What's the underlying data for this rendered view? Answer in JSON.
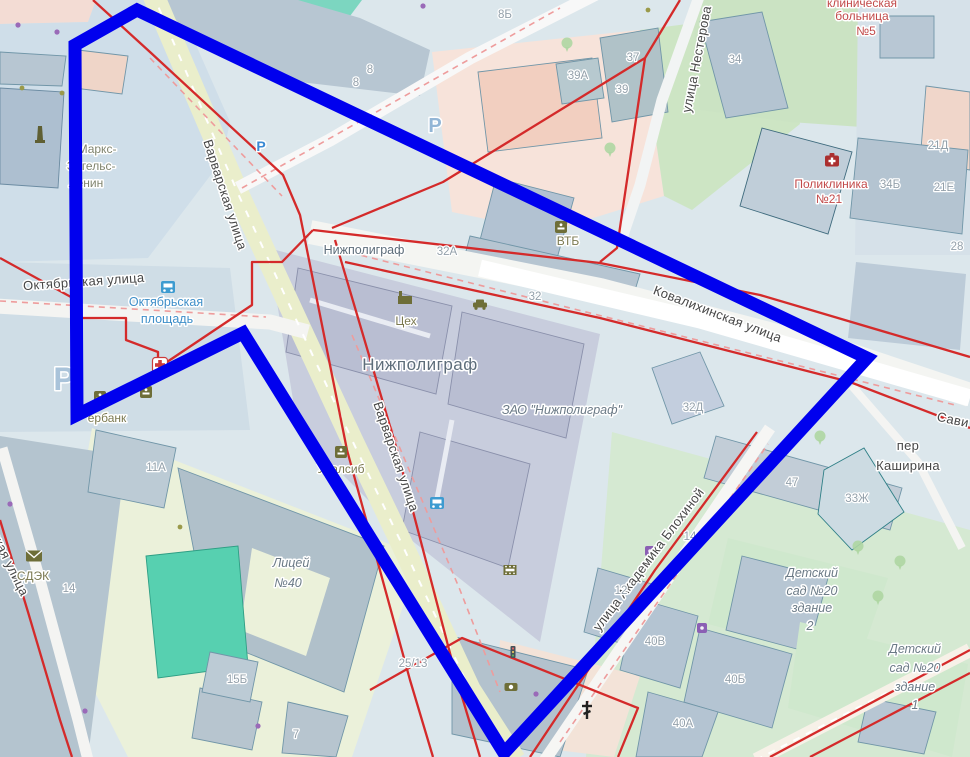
{
  "map": {
    "overlay_color": "#0000ee",
    "boundary_color": "#d42a2a",
    "boundary_dash_color": "#ee9c9c",
    "selection_polygon": [
      [
        75,
        45
      ],
      [
        137,
        10
      ],
      [
        867,
        358
      ],
      [
        504,
        753
      ],
      [
        243,
        333
      ],
      [
        77,
        415
      ]
    ],
    "red_boundaries": [
      [
        [
          93,
          0
        ],
        [
          150,
          52
        ],
        [
          283,
          175
        ],
        [
          300,
          215
        ],
        [
          347,
          450
        ],
        [
          410,
          680
        ],
        [
          433,
          757
        ]
      ],
      [
        [
          335,
          240
        ],
        [
          397,
          450
        ],
        [
          457,
          680
        ],
        [
          480,
          757
        ]
      ],
      [
        [
          680,
          0
        ],
        [
          645,
          58
        ],
        [
          443,
          182
        ],
        [
          332,
          228
        ]
      ],
      [
        [
          645,
          58
        ],
        [
          617,
          248
        ],
        [
          600,
          262
        ]
      ],
      [
        [
          313,
          230
        ],
        [
          600,
          263
        ],
        [
          760,
          295
        ],
        [
          970,
          357
        ]
      ],
      [
        [
          345,
          262
        ],
        [
          600,
          318
        ],
        [
          850,
          382
        ],
        [
          970,
          428
        ]
      ],
      [
        [
          0,
          258
        ],
        [
          80,
          302
        ],
        [
          80,
          318
        ],
        [
          126,
          318
        ],
        [
          126,
          340
        ],
        [
          158,
          352
        ],
        [
          158,
          368
        ],
        [
          252,
          305
        ],
        [
          252,
          262
        ],
        [
          282,
          262
        ],
        [
          313,
          230
        ]
      ],
      [
        [
          530,
          757
        ],
        [
          655,
          570
        ],
        [
          757,
          432
        ]
      ],
      [
        [
          370,
          690
        ],
        [
          462,
          638
        ],
        [
          638,
          708
        ],
        [
          618,
          757
        ]
      ],
      [
        [
          770,
          757
        ],
        [
          970,
          650
        ]
      ],
      [
        [
          810,
          757
        ],
        [
          970,
          673
        ]
      ],
      [
        [
          0,
          520
        ],
        [
          28,
          612
        ],
        [
          60,
          720
        ],
        [
          72,
          757
        ]
      ]
    ],
    "dashed_boundaries": [
      [
        [
          150,
          58
        ],
        [
          282,
          196
        ]
      ],
      [
        [
          0,
          301
        ],
        [
          266,
          317
        ]
      ],
      [
        [
          340,
          250
        ],
        [
          955,
          405
        ]
      ],
      [
        [
          242,
          188
        ],
        [
          560,
          8
        ]
      ],
      [
        [
          352,
          335
        ],
        [
          460,
          590
        ],
        [
          500,
          692
        ]
      ],
      [
        [
          560,
          742
        ],
        [
          768,
          444
        ]
      ]
    ],
    "labels": [
      {
        "n": "street-varvarskaya-upper",
        "t": "Варварская улица",
        "x": 221,
        "y": 196,
        "r": 72,
        "c": "street"
      },
      {
        "n": "street-varvarskaya-lower",
        "t": "Варварская улица",
        "x": 392,
        "y": 458,
        "r": 71,
        "c": "street"
      },
      {
        "n": "street-oktyabrskaya",
        "t": "Октябрьская улица",
        "x": 84,
        "y": 286,
        "r": -4,
        "c": "street"
      },
      {
        "n": "street-kovalikhinskaya",
        "t": "Ковалихинская улица",
        "x": 716,
        "y": 318,
        "r": 21,
        "c": "street"
      },
      {
        "n": "street-akademika-blokhinoy",
        "t": "улица Академика Блохиной",
        "x": 652,
        "y": 562,
        "r": -53,
        "c": "street",
        "sz": 12.5
      },
      {
        "n": "street-nesterova-partial",
        "t": "улица Нестерова",
        "x": 701,
        "y": 60,
        "r": -79,
        "c": "street",
        "a": "start"
      },
      {
        "n": "street-partial-left",
        "t": "ская улица",
        "x": 6,
        "y": 566,
        "r": 64,
        "c": "street",
        "a": "start"
      },
      {
        "n": "street-per",
        "t": "пер",
        "x": 908,
        "y": 450,
        "c": "street"
      },
      {
        "n": "street-kashirina",
        "t": "Каширина",
        "x": 908,
        "y": 470,
        "c": "street"
      },
      {
        "n": "street-savi-partial",
        "t": "Сави",
        "x": 952,
        "y": 424,
        "r": 12,
        "c": "street"
      },
      {
        "n": "label-oktyabrskaya-ploshchad-1",
        "t": "Октябрьская",
        "x": 166,
        "y": 306,
        "c": "blue"
      },
      {
        "n": "label-oktyabrskaya-ploshchad-2",
        "t": "площадь",
        "x": 167,
        "y": 323,
        "c": "blue"
      },
      {
        "n": "label-klinicheskaya",
        "t": "клиническая",
        "x": 862,
        "y": 7,
        "c": "red"
      },
      {
        "n": "label-bolnitsa",
        "t": "больница",
        "x": 862,
        "y": 20,
        "c": "red"
      },
      {
        "n": "label-no5",
        "t": "№5",
        "x": 866,
        "y": 35,
        "c": "red"
      },
      {
        "n": "label-poliklinika",
        "t": "Поликлиника",
        "x": 831,
        "y": 188,
        "c": "red"
      },
      {
        "n": "label-no21",
        "t": "№21",
        "x": 829,
        "y": 203,
        "c": "red"
      },
      {
        "n": "label-tseh",
        "t": "Цех",
        "x": 406,
        "y": 325,
        "c": "poi"
      },
      {
        "n": "label-vtb",
        "t": "ВТБ",
        "x": 568,
        "y": 245,
        "c": "poi"
      },
      {
        "n": "label-uralsib",
        "t": "Уралсиб",
        "x": 341,
        "y": 473,
        "c": "poi"
      },
      {
        "n": "label-sdek",
        "t": "СДЭК",
        "x": 33,
        "y": 580,
        "c": "poi"
      },
      {
        "n": "label-sberbank-partial",
        "t": "ербанк",
        "x": 107,
        "y": 422,
        "c": "poi"
      },
      {
        "n": "label-marks",
        "t": "Маркс-",
        "x": 97,
        "y": 153,
        "c": "poim"
      },
      {
        "n": "label-engels",
        "t": "Энгельс-",
        "x": 91,
        "y": 170,
        "c": "poim"
      },
      {
        "n": "label-lenin",
        "t": "Ленин",
        "x": 86,
        "y": 187,
        "c": "poim"
      },
      {
        "n": "label-nizhpoligraf-small",
        "t": "Нижполиграф",
        "x": 364,
        "y": 254,
        "c": "place"
      },
      {
        "n": "label-nizhpoligraf-big",
        "t": "Нижполиграф",
        "x": 420,
        "y": 370,
        "c": "placeLg"
      },
      {
        "n": "label-zao-nizhpoligraf",
        "t": "ЗАО \"Нижполиграф\"",
        "x": 562,
        "y": 414,
        "c": "it",
        "sz": 13.5
      },
      {
        "n": "label-licey",
        "t": "Лицей",
        "x": 291,
        "y": 567,
        "c": "it"
      },
      {
        "n": "label-licey-no40",
        "t": "№40",
        "x": 288,
        "y": 587,
        "c": "it"
      },
      {
        "n": "label-detsad2-1",
        "t": "Детский",
        "x": 812,
        "y": 577,
        "c": "it",
        "sz": 12
      },
      {
        "n": "label-detsad2-2",
        "t": "сад №20",
        "x": 812,
        "y": 595,
        "c": "it",
        "sz": 12
      },
      {
        "n": "label-detsad2-3",
        "t": "здание",
        "x": 812,
        "y": 612,
        "c": "it",
        "sz": 12
      },
      {
        "n": "label-detsad2-4",
        "t": "2",
        "x": 810,
        "y": 630,
        "c": "it",
        "sz": 12
      },
      {
        "n": "label-detsad1-1",
        "t": "Детский",
        "x": 915,
        "y": 653,
        "c": "it",
        "sz": 12
      },
      {
        "n": "label-detsad1-2",
        "t": "сад №20",
        "x": 915,
        "y": 672,
        "c": "it",
        "sz": 12
      },
      {
        "n": "label-detsad1-3",
        "t": "здание",
        "x": 915,
        "y": 691,
        "c": "it",
        "sz": 12
      },
      {
        "n": "label-detsad1-4",
        "t": "1",
        "x": 915,
        "y": 709,
        "c": "it",
        "sz": 12
      },
      {
        "n": "num-8b",
        "t": "8Б",
        "x": 505,
        "y": 18,
        "c": "num"
      },
      {
        "n": "num-8-upper",
        "t": "8",
        "x": 370,
        "y": 73,
        "c": "num"
      },
      {
        "n": "num-8-lower",
        "t": "8",
        "x": 356,
        "y": 86,
        "c": "num"
      },
      {
        "n": "num-37",
        "t": "37",
        "x": 633,
        "y": 61,
        "c": "num"
      },
      {
        "n": "num-39a",
        "t": "39А",
        "x": 578,
        "y": 79,
        "c": "num"
      },
      {
        "n": "num-39",
        "t": "39",
        "x": 622,
        "y": 93,
        "c": "num"
      },
      {
        "n": "num-34",
        "t": "34",
        "x": 735,
        "y": 63,
        "c": "num"
      },
      {
        "n": "num-21d",
        "t": "21Д",
        "x": 938,
        "y": 149,
        "c": "num"
      },
      {
        "n": "num-21e",
        "t": "21Е",
        "x": 944,
        "y": 191,
        "c": "num"
      },
      {
        "n": "num-34b",
        "t": "34Б",
        "x": 890,
        "y": 188,
        "c": "num"
      },
      {
        "n": "num-28",
        "t": "28",
        "x": 957,
        "y": 250,
        "c": "num"
      },
      {
        "n": "num-32a",
        "t": "32А",
        "x": 447,
        "y": 255,
        "c": "num"
      },
      {
        "n": "num-32",
        "t": "32",
        "x": 535,
        "y": 300,
        "c": "num"
      },
      {
        "n": "num-32d",
        "t": "32Д",
        "x": 693,
        "y": 411,
        "c": "num"
      },
      {
        "n": "num-14-right",
        "t": "14",
        "x": 690,
        "y": 540,
        "c": "num"
      },
      {
        "n": "num-47",
        "t": "47",
        "x": 792,
        "y": 486,
        "c": "num"
      },
      {
        "n": "num-33zh",
        "t": "33Ж",
        "x": 857,
        "y": 502,
        "c": "num"
      },
      {
        "n": "num-12",
        "t": "12",
        "x": 621,
        "y": 594,
        "c": "num"
      },
      {
        "n": "num-40v",
        "t": "40В",
        "x": 655,
        "y": 645,
        "c": "num"
      },
      {
        "n": "num-40b",
        "t": "40Б",
        "x": 735,
        "y": 683,
        "c": "num"
      },
      {
        "n": "num-40a",
        "t": "40А",
        "x": 683,
        "y": 727,
        "c": "num"
      },
      {
        "n": "num-25-13",
        "t": "25/13",
        "x": 413,
        "y": 667,
        "c": "num"
      },
      {
        "n": "num-15b",
        "t": "15Б",
        "x": 237,
        "y": 683,
        "c": "num"
      },
      {
        "n": "num-7",
        "t": "7",
        "x": 296,
        "y": 738,
        "c": "num"
      },
      {
        "n": "num-14-left",
        "t": "14",
        "x": 69,
        "y": 592,
        "c": "num"
      },
      {
        "n": "num-11a",
        "t": "11А",
        "x": 156,
        "y": 471,
        "c": "num"
      }
    ],
    "icons": [
      {
        "k": "parking-small",
        "x": 261,
        "y": 151
      },
      {
        "k": "parking",
        "x": 435,
        "y": 132
      },
      {
        "k": "parking-large",
        "x": 64,
        "y": 390
      },
      {
        "k": "bus-stop",
        "x": 168,
        "y": 287
      },
      {
        "k": "bus-stop",
        "x": 437,
        "y": 503
      },
      {
        "k": "pharmacy",
        "x": 160,
        "y": 365
      },
      {
        "k": "hospital",
        "x": 832,
        "y": 161
      },
      {
        "k": "bank-vtb",
        "x": 561,
        "y": 227
      },
      {
        "k": "bank-sber",
        "x": 100,
        "y": 397
      },
      {
        "k": "bank-atm",
        "x": 146,
        "y": 392
      },
      {
        "k": "bank-uralsib",
        "x": 341,
        "y": 452
      },
      {
        "k": "factory",
        "x": 405,
        "y": 299
      },
      {
        "k": "taxi",
        "x": 480,
        "y": 305
      },
      {
        "k": "cinema",
        "x": 510,
        "y": 570
      },
      {
        "k": "traffic-light",
        "x": 513,
        "y": 652
      },
      {
        "k": "camera",
        "x": 511,
        "y": 687
      },
      {
        "k": "church",
        "x": 587,
        "y": 711
      },
      {
        "k": "post-cdek",
        "x": 34,
        "y": 556
      },
      {
        "k": "monument",
        "x": 40,
        "y": 135
      },
      {
        "k": "shop-purple",
        "x": 702,
        "y": 628
      },
      {
        "k": "shop-purple",
        "x": 650,
        "y": 551
      },
      {
        "k": "dot-purple",
        "x": 18,
        "y": 25
      },
      {
        "k": "dot-purple",
        "x": 57,
        "y": 32
      },
      {
        "k": "dot-purple",
        "x": 423,
        "y": 6
      },
      {
        "k": "dot-purple",
        "x": 10,
        "y": 504
      },
      {
        "k": "dot-purple",
        "x": 85,
        "y": 711
      },
      {
        "k": "dot-purple",
        "x": 258,
        "y": 726
      },
      {
        "k": "dot-purple",
        "x": 536,
        "y": 694
      },
      {
        "k": "dot-khaki",
        "x": 22,
        "y": 88
      },
      {
        "k": "dot-khaki",
        "x": 62,
        "y": 93
      },
      {
        "k": "dot-khaki",
        "x": 648,
        "y": 10
      },
      {
        "k": "dot-khaki",
        "x": 180,
        "y": 527
      },
      {
        "k": "tree-pin",
        "x": 567,
        "y": 45
      },
      {
        "k": "tree-pin",
        "x": 610,
        "y": 150
      },
      {
        "k": "tree-pin",
        "x": 820,
        "y": 438
      },
      {
        "k": "tree-pin",
        "x": 858,
        "y": 548
      },
      {
        "k": "tree-pin",
        "x": 900,
        "y": 563
      },
      {
        "k": "tree-pin",
        "x": 878,
        "y": 598
      }
    ]
  }
}
